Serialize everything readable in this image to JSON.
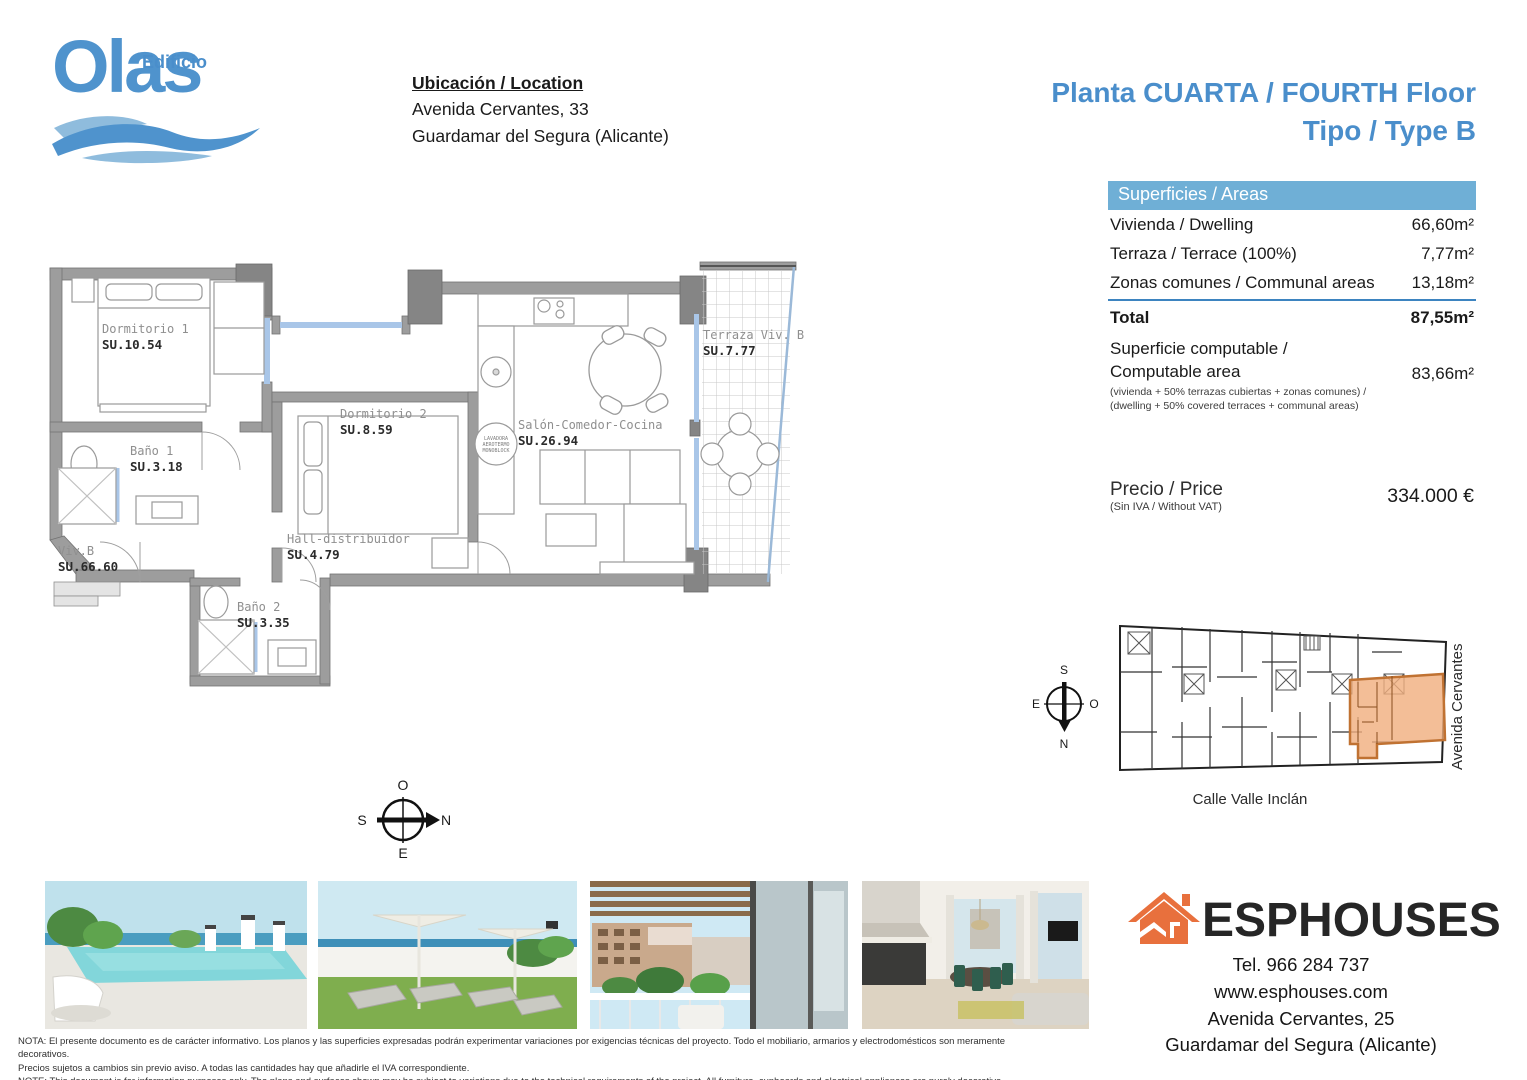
{
  "logo": {
    "edificio": "Edificio",
    "olas": "Olas"
  },
  "location": {
    "heading": "Ubicación / Location",
    "line1": "Avenida Cervantes, 33",
    "line2": "Guardamar del Segura (Alicante)"
  },
  "title": {
    "line1": "Planta CUARTA / FOURTH Floor",
    "line2": "Tipo / Type B"
  },
  "areas": {
    "header": "Superficies / Areas",
    "rows": [
      {
        "label": "Vivienda / Dwelling",
        "value": "66,60m²"
      },
      {
        "label": "Terraza / Terrace (100%)",
        "value": "7,77m²"
      },
      {
        "label": "Zonas comunes / Communal areas",
        "value": "13,18m²"
      }
    ],
    "total": {
      "label": "Total",
      "value": "87,55m²"
    },
    "computable": {
      "label_line1": "Superficie computable /",
      "label_line2": "Computable area",
      "value": "83,66m²",
      "note_line1": "(vivienda + 50% terrazas cubiertas + zonas comunes) /",
      "note_line2": "(dwelling + 50% covered terraces + communal areas)"
    },
    "price": {
      "label": "Precio / Price",
      "note": "(Sin IVA / Without VAT)",
      "value": "334.000 €"
    }
  },
  "plan": {
    "rooms": [
      {
        "name": "Dormitorio 1",
        "su": "SU.10.54"
      },
      {
        "name": "Baño 1",
        "su": "SU.3.18"
      },
      {
        "name": "Dormitorio 2",
        "su": "SU.8.59"
      },
      {
        "name": "Hall-distribuidor",
        "su": "SU.4.79"
      },
      {
        "name": "Baño 2",
        "su": "SU.3.35"
      },
      {
        "name": "Salón-Comedor-Cocina",
        "su": "SU.26.94"
      },
      {
        "name": "Terraza Viv. B",
        "su": "SU.7.77"
      },
      {
        "name": "Viv.B",
        "su": "SU.66.60"
      }
    ],
    "washer": {
      "line1": "LAVADORA",
      "line2": "AEROTERMO",
      "line3": "MONOBLOCK"
    },
    "compass": {
      "top": "O",
      "right": "N",
      "bottom": "E",
      "left": "S"
    }
  },
  "siteplan": {
    "compass": {
      "top": "S",
      "right": "O",
      "bottom": "N",
      "left": "E"
    },
    "street_right": "Avenida Cervantes",
    "street_bottom": "Calle Valle Inclán",
    "highlight_color": "#f0ae7d"
  },
  "agency": {
    "name": "ESPHOUSES",
    "phone": "Tel. 966 284 737",
    "web": "www.esphouses.com",
    "address1": "Avenida Cervantes, 25",
    "address2": "Guardamar del Segura (Alicante)",
    "brand_color": "#e8703d"
  },
  "footer": {
    "note_es_1": "NOTA: El presente documento es de carácter informativo. Los planos y las superficies expresadas podrán experimentar variaciones por exigencias técnicas del proyecto. Todo el mobiliario, armarios y electrodomésticos son meramente decorativos.",
    "note_es_2": "Precios sujetos a cambios sin previo aviso. A todas las cantidades hay que añadirle el IVA correspondiente.",
    "note_en_1": "NOTE: This document is for information purposes only. The plans and surfaces shown may be subject to variations due to the technical requirements of the project. All furniture, cupboards and electrical appliances are purely decorative.",
    "note_en_2": "Prices subject to change without notice. VAT must be added to all amounts."
  }
}
